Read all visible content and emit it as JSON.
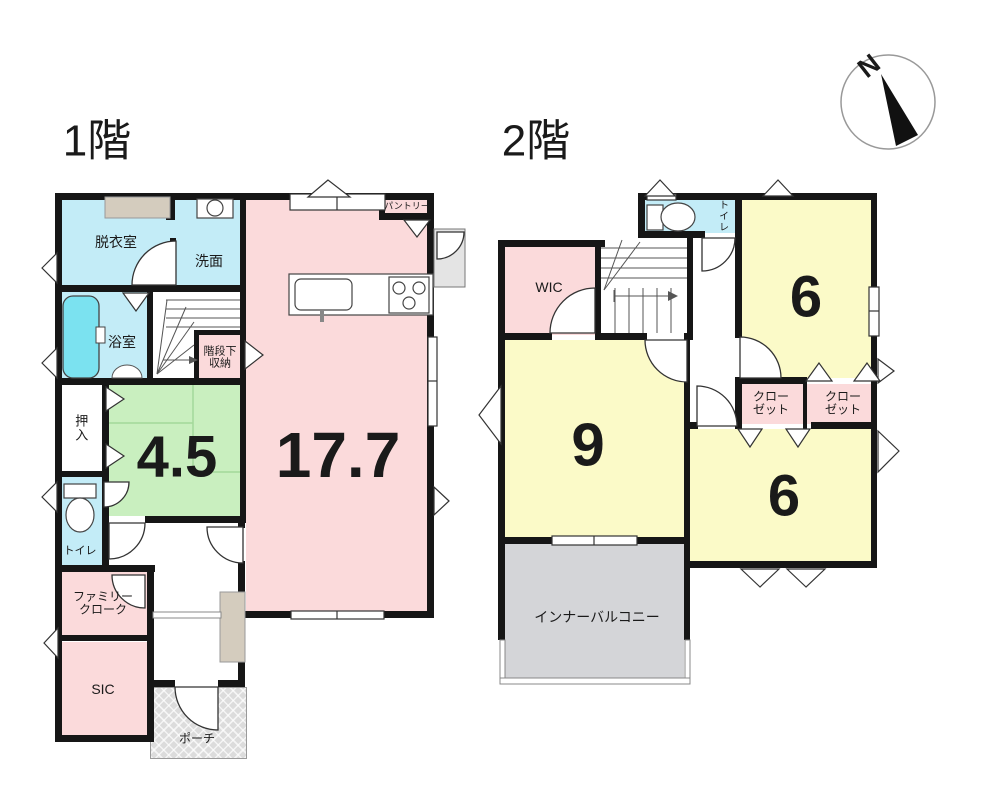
{
  "titles": {
    "floor1": "1階",
    "floor2": "2階"
  },
  "compass": {
    "north": "N"
  },
  "colors": {
    "wall": "#161616",
    "room_pink": "#fbdadb",
    "room_blue": "#c3ecf7",
    "room_green": "#c9efbf",
    "room_yellow": "#fbfac8",
    "room_gray": "#d4d5d8",
    "tub_cyan": "#7be2f0",
    "beige": "#d4ccbe",
    "line": "#555555"
  },
  "floor1": {
    "rooms": {
      "dressing": "脱衣室",
      "washroom": "洗面",
      "bathroom": "浴室",
      "under_stair_storage": "階段下\n収納",
      "pantry": "パントリー",
      "oshiire": "押入",
      "tatami_size": "4.5",
      "ldk_size": "17.7",
      "toilet": "トイレ",
      "family_cloak": "ファミリー\nクローク",
      "sic": "SIC",
      "porch": "ポーチ"
    }
  },
  "floor2": {
    "rooms": {
      "wic": "WIC",
      "toilet": "トイレ",
      "bedroom_6_upper": "6",
      "bedroom_9": "9",
      "bedroom_6_lower": "6",
      "closet_left": "クロー\nゼット",
      "closet_right": "クロー\nゼット",
      "inner_balcony": "インナーバルコニー"
    }
  }
}
